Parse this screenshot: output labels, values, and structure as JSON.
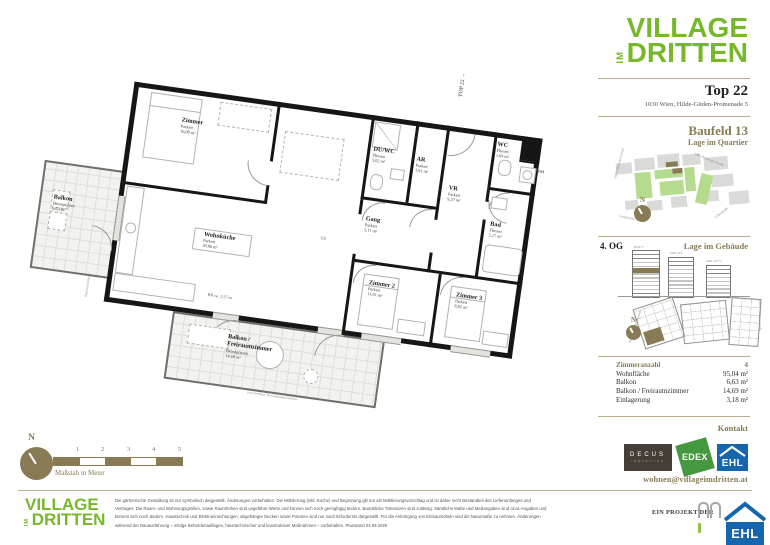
{
  "brand": {
    "word1": "VILLAGE",
    "word_im": "IM",
    "word2": "DRITTEN",
    "green": "#76b82a"
  },
  "header": {
    "unit": "Top 22",
    "address": "1030 Wien, Hilde-Güden-Promenade 5"
  },
  "quartier": {
    "title": "Baufeld 13",
    "subtitle": "Lage im Quartier",
    "north": "N",
    "streets": [
      "Adolf-Blamauer-Gasse",
      "Otto-Preminger-Straße",
      "Landstraßer Gürtel",
      "Leberstraße"
    ]
  },
  "gebaeude": {
    "floor": "4. OG",
    "title": "Lage im Gebäude",
    "north": "N",
    "buildings": [
      "HGP 5",
      "OPS 123",
      "OPS 121+2"
    ],
    "plan_streets": [
      "Hilde-Güden-Promenade",
      "Otto-Preminger-Straße"
    ]
  },
  "details": {
    "rows": [
      {
        "label": "Zimmeranzahl",
        "value": "4"
      },
      {
        "label": "Wohnfläche",
        "value": "95,04 m²"
      },
      {
        "label": "Balkon",
        "value": "6,63 m²"
      },
      {
        "label": "Balkon / Freiraumzimmer",
        "value": "14,69 m²"
      },
      {
        "label": "Einlagerung",
        "value": "3,18 m²"
      }
    ]
  },
  "kontakt": {
    "title": "Kontakt",
    "email": "wohnen@villageimdritten.at",
    "decus": [
      "DECUS",
      "IMMOBILIEN"
    ],
    "edex": "EDEX",
    "ehl": "EHL"
  },
  "plan": {
    "top_label": "TOP 22",
    "top_arrow": "→",
    "rooms": [
      {
        "name": "Zimmer",
        "floor": "Parkett",
        "area": "16,08 m²"
      },
      {
        "name": "Wohnküche",
        "floor": "Parkett",
        "area": "30,86 m²"
      },
      {
        "name": "DU/WC",
        "floor": "Fliesen",
        "area": "5,02 m²"
      },
      {
        "name": "AR",
        "floor": "Parkett",
        "area": "1,91 m²"
      },
      {
        "name": "VR",
        "floor": "Parkett",
        "area": "9,37 m²"
      },
      {
        "name": "Gang",
        "floor": "Parkett",
        "area": "5,11 m²"
      },
      {
        "name": "WC",
        "floor": "Fliesen",
        "area": "1,69 m²"
      },
      {
        "name": "Bad",
        "floor": "Fliesen",
        "area": "5,17 m²"
      },
      {
        "name": "Zimmer 2",
        "floor": "Parkett",
        "area": "11,01 m²"
      },
      {
        "name": "Zimmer 3",
        "floor": "Parkett",
        "area": "8,82 m²"
      },
      {
        "name": "Balkon",
        "floor": "Betonplatten",
        "area": "6,63 m²"
      },
      {
        "name": "Balkon / Freiraumzimmer",
        "floor": "Betonplatten",
        "area": "14,69 m²"
      }
    ],
    "notes": {
      "wm": "WM",
      "gs": "GS",
      "rh": "RH ca. 2,57 m",
      "absturz": "Absturzsicherung",
      "verschattung": "verschiebbare Verschattungselemente"
    }
  },
  "scalebar": {
    "ticks": [
      "1",
      "2",
      "3",
      "4",
      "5"
    ],
    "label": "Maßstab in Meter",
    "north": "N"
  },
  "footer": {
    "project_label": "EIN PROJEKT DER",
    "ehl": "EHL",
    "disclaimer": "Die gärtnerische Gestaltung ist nur symbolisch dargestellt. Änderungen vorbehalten. Die Möblierung (inkl. Küche) und Begrünung gilt nur als Möblierungsvorschlag und ist daher nicht Bestandteil des Lieferumfanges und Vertrages. Die Raum- und Wohnungsgrößen, sowie Raumhöhen sind ungefähre Werte und können sich noch geringfügig ändern. Bauübliche Toleranzen sind zulässig. Sämtliche Maße und Maßangaben sind circa-Angaben und können sich noch ändern. Haustechnik und Elektroeinrichtungen, abgehängte Decken sowie Poterien sind nur nach Erfordernis dargestellt. Für die Anfertigung von Einbaumöbeln sind die Naturmaße zu nehmen. Änderungen während der Bauausführung – infolge Behördenauflagen, haustechnischer und konstruktiver Maßnahmen – vorbehalten. Planstand 04.09.2025"
  },
  "colors": {
    "accent": "#877a55",
    "brand_green": "#76b82a",
    "ehl_blue": "#1566ad",
    "edex_green": "#45983d",
    "decus_bg": "#453e37",
    "map_green": "#b5dc8e",
    "map_gray": "#dadad8"
  }
}
